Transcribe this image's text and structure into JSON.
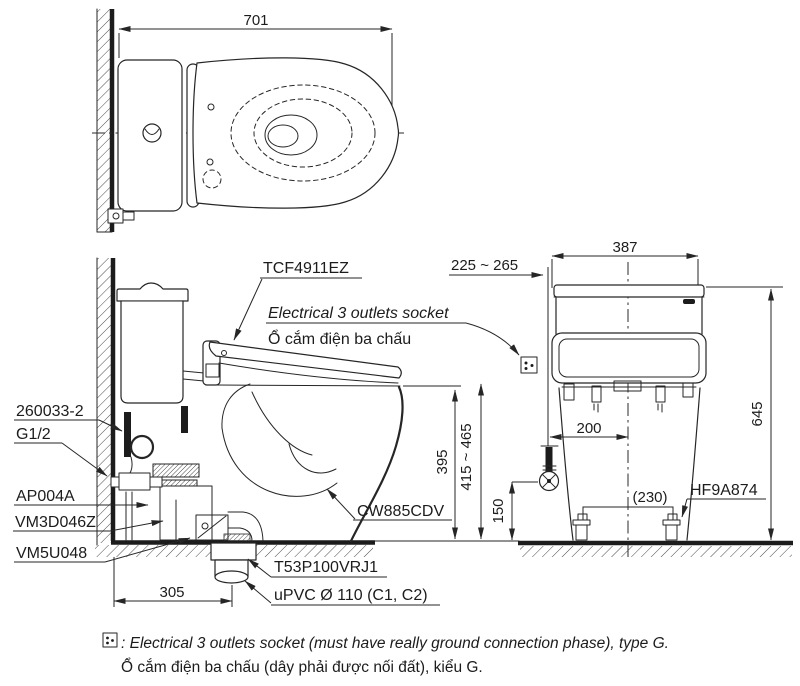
{
  "labels": {
    "tcf4911ez": "TCF4911EZ",
    "socket_en": "Electrical 3 outlets socket",
    "socket_vi": "Ổ cắm điện ba chấu",
    "p260033": "260033-2",
    "g12": "G1/2",
    "ap004a": "AP004A",
    "vm3d046z": "VM3D046Z",
    "vm5u048": "VM5U048",
    "cw885cdv": "CW885CDV",
    "t53p100vrj1": "T53P100VRJ1",
    "upvc": "uPVC Ø 110 (C1, C2)",
    "hf9a874": "HF9A874"
  },
  "dims": {
    "top_width": "701",
    "tank_width": "387",
    "supply_range": "225 ~ 265",
    "total_height": "645",
    "rim_height": "395",
    "seat_height": "415 ~ 465",
    "supply_offset": "200",
    "supply_height": "150",
    "bolt_spacing": "(230)",
    "drain_offset": "305"
  },
  "note": {
    "line1": ": Electrical 3 outlets socket (must have really ground connection phase), type G.",
    "line2": "Ổ cắm điện ba chấu (dây phải được nối đất), kiểu G."
  }
}
